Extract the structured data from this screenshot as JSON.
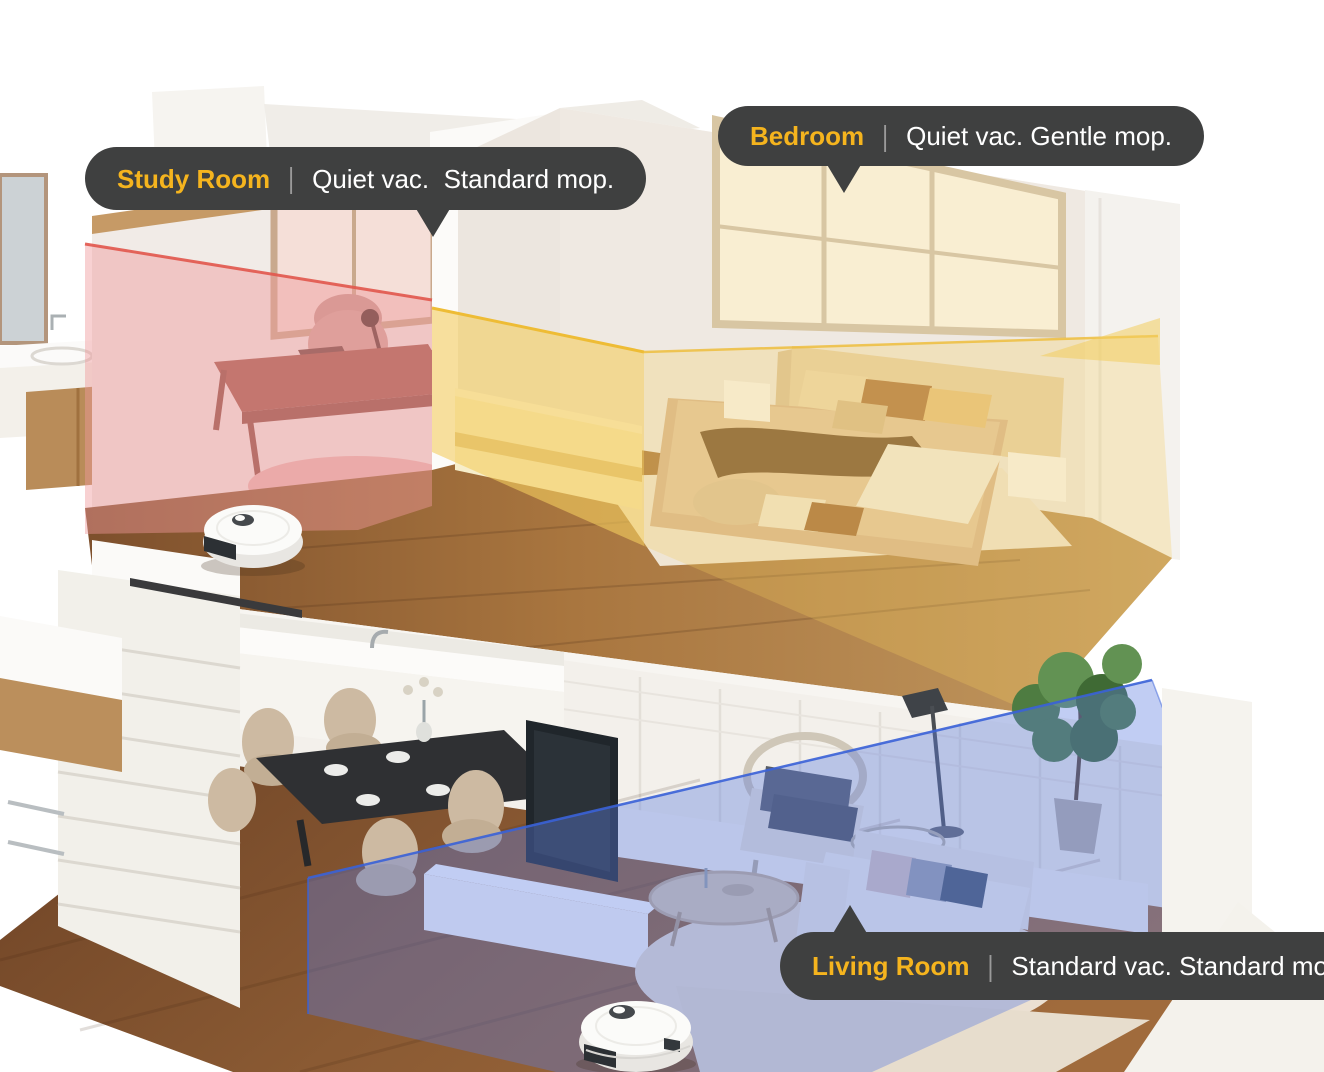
{
  "image": {
    "alt": "Cutaway two-story home showing per-room robot vacuum cleaning settings"
  },
  "colors": {
    "background": "#ffffff",
    "bubble_bg": "#3f4040",
    "accent": "#f5b41e",
    "callout_text": "#ffffff",
    "callout_divider": "#9a9a9a",
    "zone_study_fill": "#ef9a9c",
    "zone_study_edge": "#e2574d",
    "zone_bedroom_fill": "#f3cd5f",
    "zone_bedroom_edge": "#eebc35",
    "zone_living_fill": "#5b7ce0",
    "zone_living_edge": "#3a62d8"
  },
  "callouts": {
    "study_room": {
      "room": "Study Room",
      "divider": "|",
      "settings": "Quiet vac.  Standard mop."
    },
    "bedroom": {
      "room": "Bedroom",
      "divider": "|",
      "settings": "Quiet vac. Gentle mop."
    },
    "living_room": {
      "room": "Living Room",
      "divider": "|",
      "settings": "Standard vac. Standard mop."
    }
  }
}
